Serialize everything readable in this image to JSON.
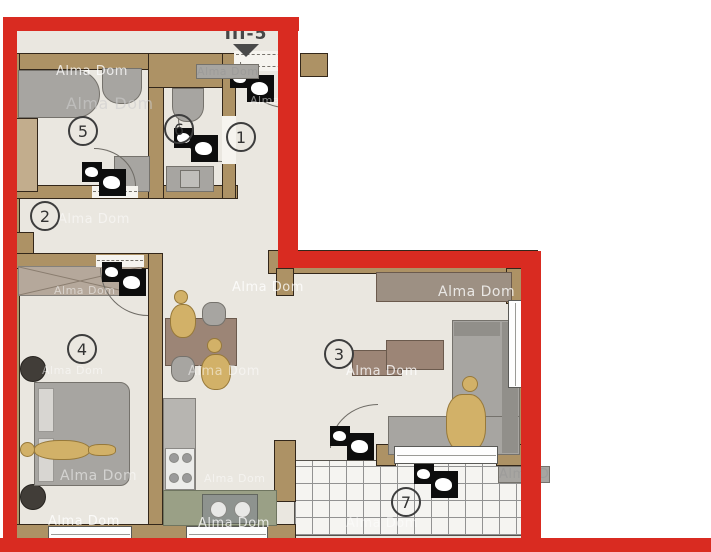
{
  "plan": {
    "unit_label": "III-5",
    "watermark": "Alma Dom",
    "watermark_partial": "Alma D",
    "rooms": [
      {
        "number": "1"
      },
      {
        "number": "2"
      },
      {
        "number": "3"
      },
      {
        "number": "4"
      },
      {
        "number": "5"
      },
      {
        "number": "6"
      },
      {
        "number": "7"
      }
    ],
    "colors": {
      "outline_red": "#d92b21",
      "wall_tan": "#ad9265",
      "floor_beige": "#eae7e0",
      "logo_black": "#0d0d0d",
      "furniture_gray": "#a7a5a1",
      "furniture_brown": "#9c8576",
      "counter_olive": "#9aa086",
      "figure_gold": "#d2b168"
    }
  }
}
